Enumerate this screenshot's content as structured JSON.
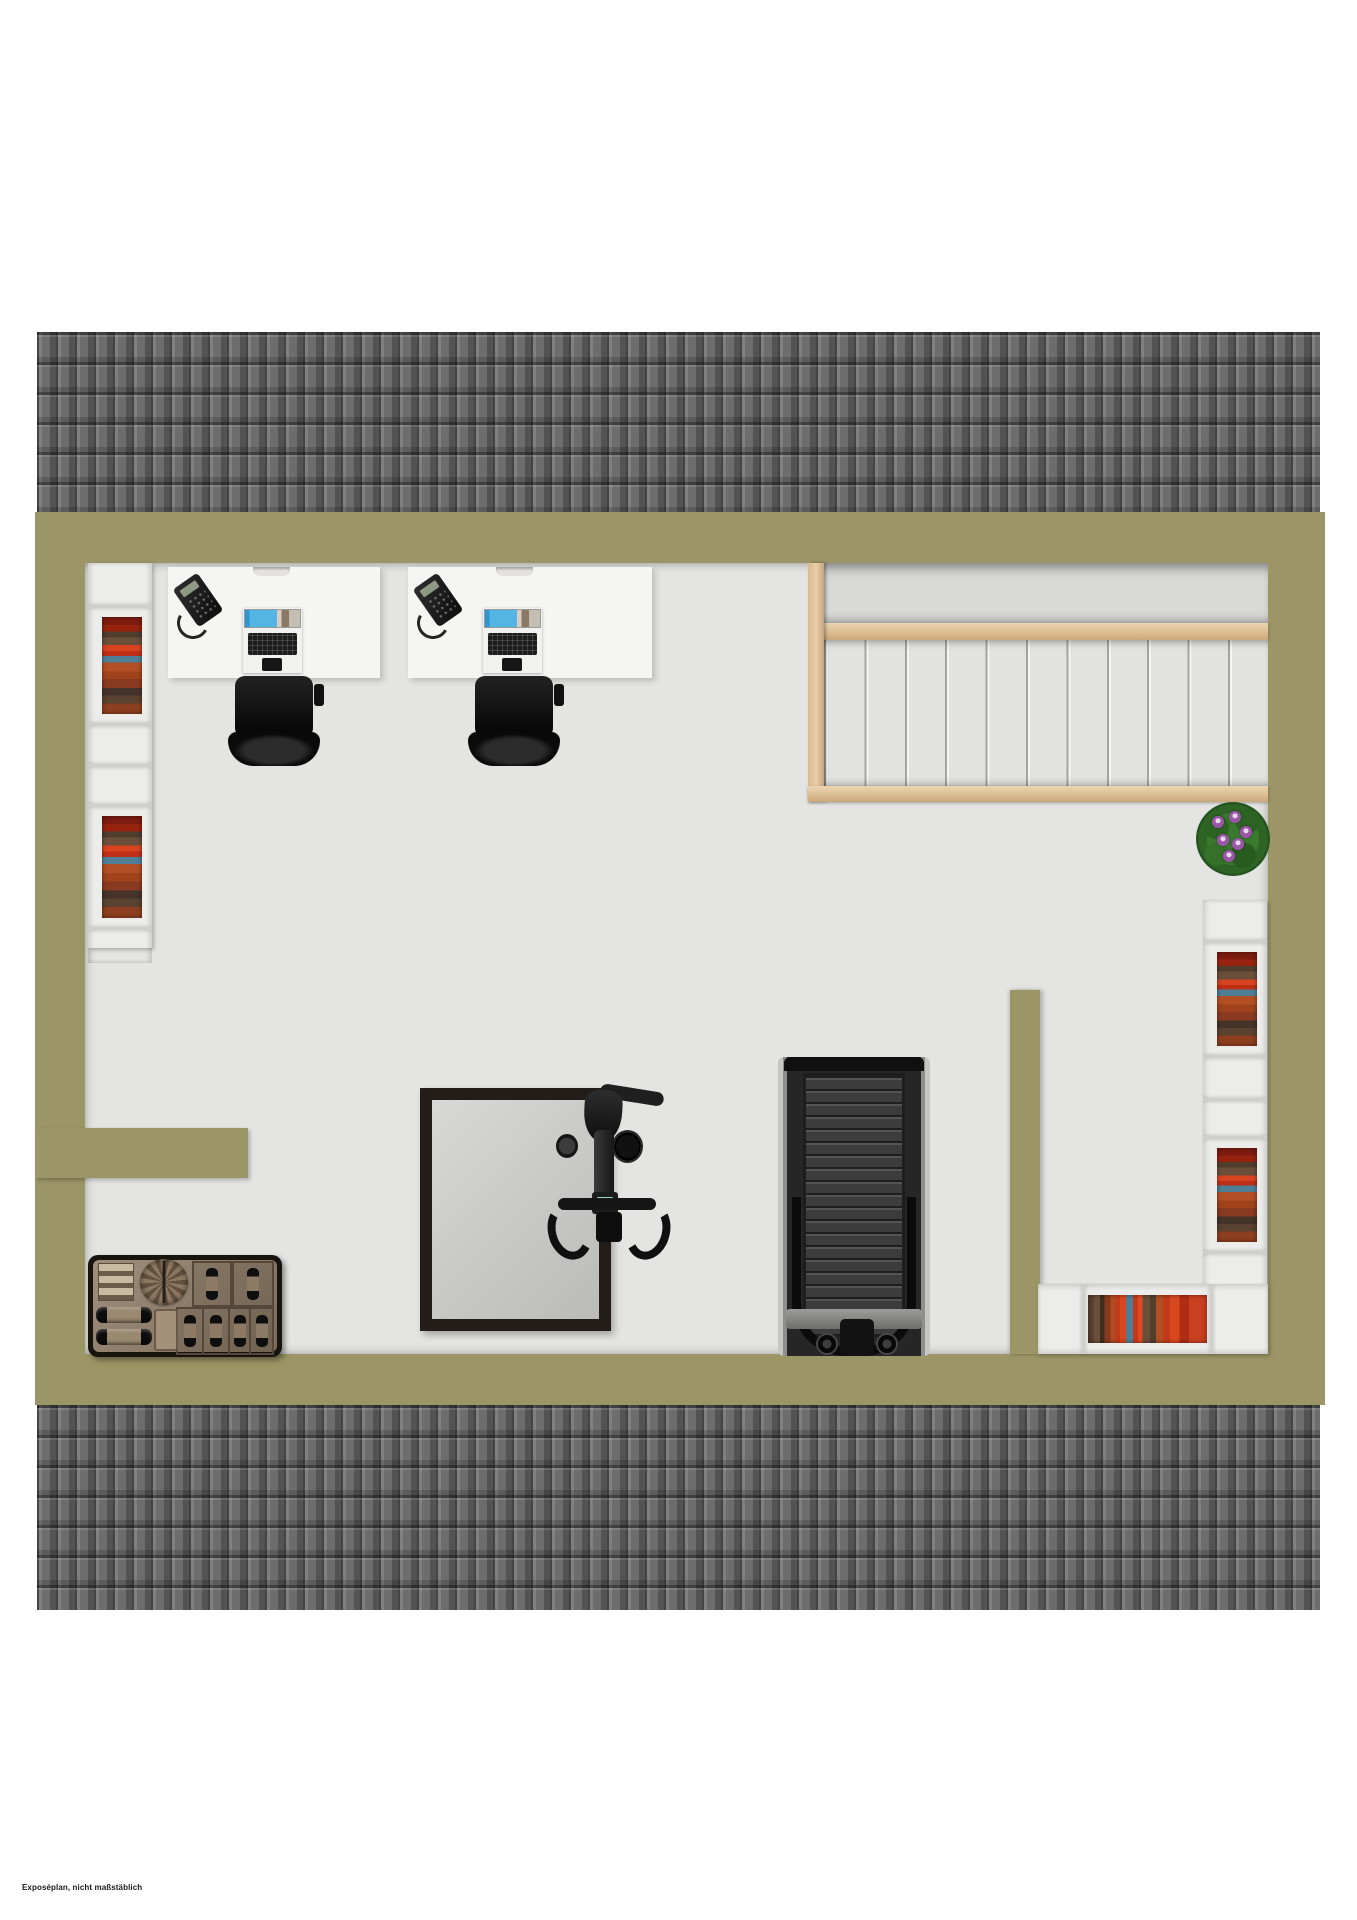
{
  "footer": {
    "note": "Exposéplan, nicht maßstäblich"
  },
  "palette": {
    "wall": "#9c9566",
    "floor": "#e4e4e2",
    "roof_base": "#6d6d6d",
    "wood": "#e2c59d",
    "shelf": "#ececea",
    "shelf_line": "#cfcfcc",
    "desk": "#f5f5f4",
    "screen_blue": "#3f9fd4",
    "frame_dark": "#221d18",
    "bench_wood": "#8f7c66",
    "bench_dark": "#17130f",
    "plant_green": "#3a7a2e",
    "flower_purple": "#9a57a8",
    "stairs_landing": "#d9d9d7",
    "steps": "#e2e2e0"
  },
  "objects": {
    "roof_tiles_top": "gray roof tile band (top)",
    "roof_tiles_bottom": "gray roof tile band (bottom)",
    "attic_wall": "olive attic wall outline",
    "bookshelf_left": "tall shelf with colored books",
    "bookshelf_right": "tall shelf with colored books",
    "sideboard_shelf": "low corner shelf with colored books",
    "desk_1": "desk with phone, monitor, keyboard, mouse",
    "desk_2": "desk with phone, monitor, keyboard, mouse",
    "office_chair": "black office chair",
    "staircase": "staircase with wooden rails and landing",
    "potted_plant": "green plant with purple flowers",
    "skylight_window": "dark framed floor opening / skylight",
    "exercise_bike": "exercise bike (top view)",
    "treadmill": "treadmill (top view)",
    "storage_bench": "weights and towel storage bench"
  }
}
